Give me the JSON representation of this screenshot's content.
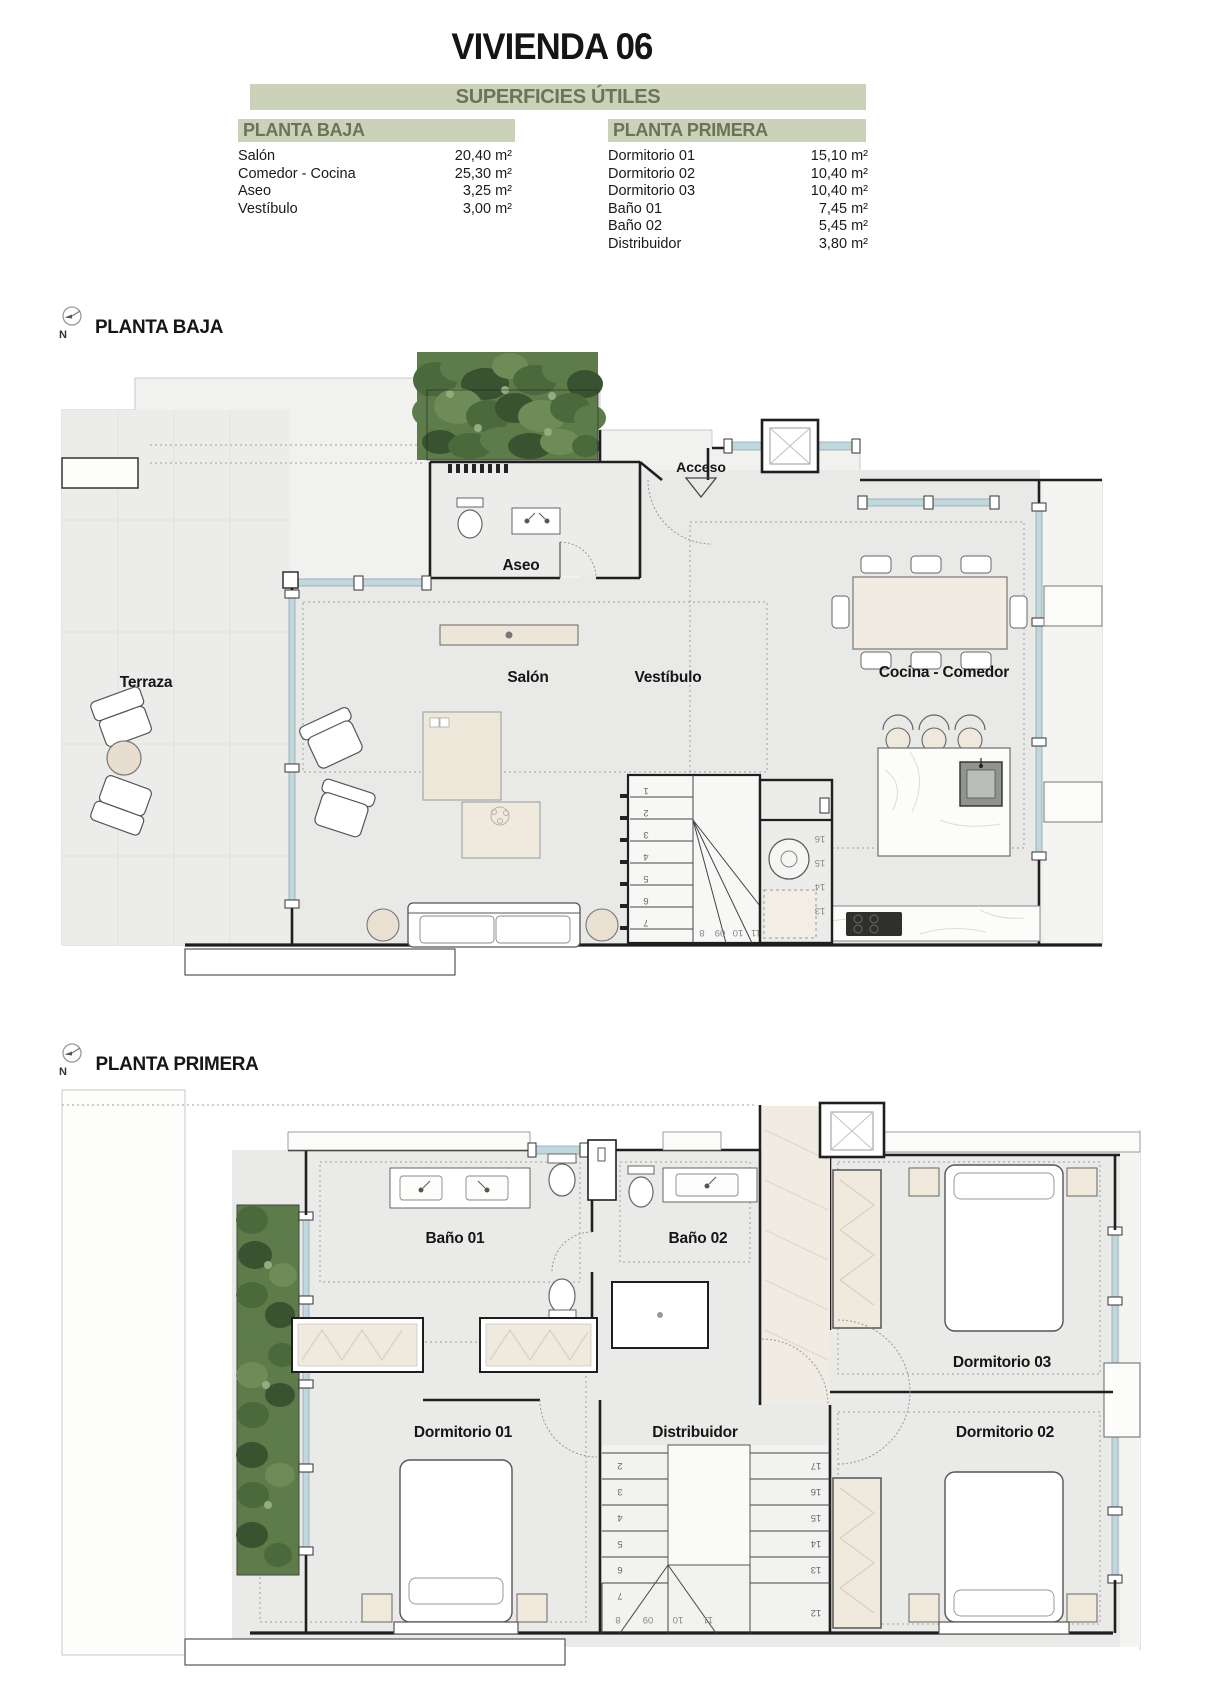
{
  "header": {
    "title": "VIVIENDA 06",
    "subtitle": "SUPERFICIES ÚTILES",
    "tables": {
      "left": {
        "title": "PLANTA BAJA",
        "rows": [
          {
            "label": "Salón",
            "value": "20,40 m²"
          },
          {
            "label": "Comedor - Cocina",
            "value": "25,30 m²"
          },
          {
            "label": "Aseo",
            "value": "3,25 m²"
          },
          {
            "label": "Vestíbulo",
            "value": "3,00 m²"
          }
        ]
      },
      "right": {
        "title": "PLANTA PRIMERA",
        "rows": [
          {
            "label": "Dormitorio 01",
            "value": "15,10 m²"
          },
          {
            "label": "Dormitorio 02",
            "value": "10,40 m²"
          },
          {
            "label": "Dormitorio 03",
            "value": "10,40 m²"
          },
          {
            "label": "Baño 01",
            "value": "7,45 m²"
          },
          {
            "label": "Baño 02",
            "value": "5,45 m²"
          },
          {
            "label": "Distribuidor",
            "value": "3,80 m²"
          }
        ]
      }
    }
  },
  "colors": {
    "accent_green_bg": "#cbd2b9",
    "accent_green_text": "#6c7456",
    "glazing_blue": "#bfd7dd",
    "plant_green": "#5e7b4a",
    "floor_gray": "#eaeae8"
  },
  "plan_ground": {
    "section_label": "PLANTA BAJA",
    "north_label": "N",
    "rooms": {
      "terraza": "Terraza",
      "aseo": "Aseo",
      "salon": "Salón",
      "vestibulo": "Vestíbulo",
      "cocina": "Cocina - Comedor",
      "acceso": "Acceso"
    },
    "stairs_main": [
      "1",
      "2",
      "3",
      "4",
      "5",
      "6",
      "7"
    ],
    "stairs_lower": [
      "8",
      "09",
      "10",
      "11"
    ],
    "stairs_upper": [
      "16",
      "15",
      "14",
      "13"
    ]
  },
  "plan_first": {
    "section_label": "PLANTA PRIMERA",
    "north_label": "N",
    "rooms": {
      "bano1": "Baño 01",
      "bano2": "Baño 02",
      "dorm1": "Dormitorio 01",
      "dorm2": "Dormitorio 02",
      "dorm3": "Dormitorio 03",
      "distribuidor": "Distribuidor"
    },
    "stairs_left": [
      "2",
      "3",
      "4",
      "5",
      "6",
      "7"
    ],
    "stairs_right": [
      "17",
      "16",
      "15",
      "14",
      "13",
      "12"
    ],
    "stairs_bottom": [
      "8",
      "09",
      "10",
      "11"
    ]
  }
}
